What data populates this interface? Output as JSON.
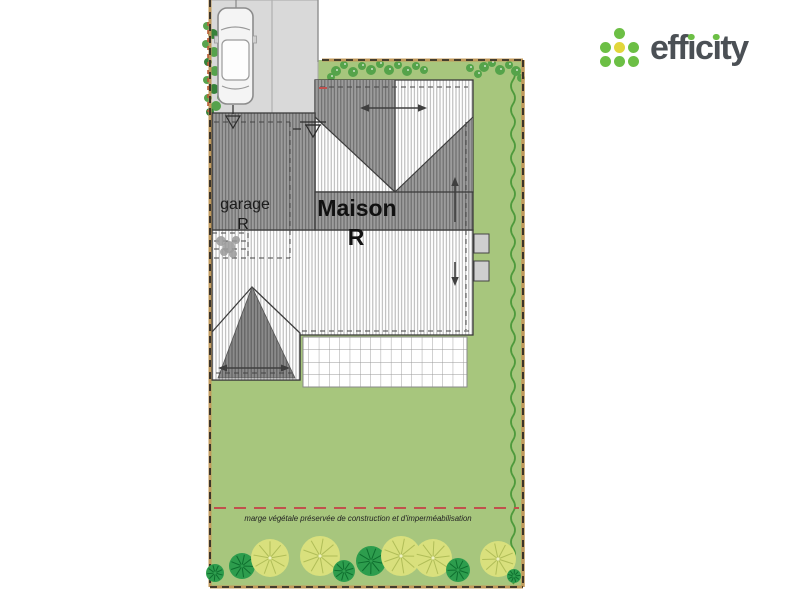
{
  "logo": {
    "name": "efficity-logo",
    "full_text": "efficity",
    "t1": "eff",
    "t2": "c",
    "t3": "ty",
    "dotless_i": "ı",
    "colors": {
      "green": "#6cbf45",
      "yellow": "#e2d63b",
      "text": "#4b5055"
    }
  },
  "plan": {
    "labels": {
      "garage_line1": "garage",
      "garage_line2": "R",
      "maison_line1": "Maison",
      "maison_line2": "R",
      "marge_note": "marge végétale préservée de construction et d'imperméabilisation"
    },
    "colors": {
      "lawn": "#a7c67d",
      "boundary_tan": "#c19a5b",
      "boundary_dash": "#1c1c1c",
      "marge_dash": "#c0504d",
      "driveway": "#d9d9d9",
      "hedge": "#4e9a3c",
      "roof_outline": "#3c3c3c",
      "window_fill": "#cfcfcf"
    },
    "decor": {
      "hedge": {
        "x": 513,
        "y1": 68,
        "y2": 584,
        "amp": 4,
        "step": 12
      },
      "tree_colors": {
        "y": {
          "fill": "#d9e07d",
          "spoke": "#b0bd58",
          "core": "#eef2c0"
        },
        "d": {
          "fill": "#2d9d4d",
          "spoke": "#0e6e2e",
          "core": "#2d9d4d"
        }
      },
      "trees": [
        {
          "x": 215,
          "y": 573,
          "r": 9,
          "c": "d"
        },
        {
          "x": 242,
          "y": 566,
          "r": 13,
          "c": "d"
        },
        {
          "x": 270,
          "y": 558,
          "r": 19,
          "c": "y"
        },
        {
          "x": 320,
          "y": 556,
          "r": 20,
          "c": "y"
        },
        {
          "x": 344,
          "y": 571,
          "r": 11,
          "c": "d"
        },
        {
          "x": 371,
          "y": 561,
          "r": 15,
          "c": "d"
        },
        {
          "x": 401,
          "y": 556,
          "r": 20,
          "c": "y"
        },
        {
          "x": 433,
          "y": 558,
          "r": 19,
          "c": "y"
        },
        {
          "x": 458,
          "y": 570,
          "r": 12,
          "c": "d"
        },
        {
          "x": 498,
          "y": 559,
          "r": 18,
          "c": "y"
        },
        {
          "x": 514,
          "y": 576,
          "r": 7,
          "c": "d"
        }
      ],
      "shrub_color": "#55a34a",
      "shrubs": [
        [
          336,
          71,
          5
        ],
        [
          344,
          65,
          4
        ],
        [
          353,
          72,
          5
        ],
        [
          362,
          66,
          4
        ],
        [
          371,
          70,
          5
        ],
        [
          380,
          64,
          4
        ],
        [
          389,
          70,
          5
        ],
        [
          398,
          65,
          4
        ],
        [
          407,
          71,
          5
        ],
        [
          416,
          66,
          4
        ],
        [
          424,
          70,
          4
        ],
        [
          331,
          77,
          4
        ],
        [
          484,
          67,
          5
        ],
        [
          492,
          63,
          4
        ],
        [
          500,
          70,
          5
        ],
        [
          509,
          65,
          4
        ],
        [
          516,
          71,
          5
        ],
        [
          521,
          78,
          4
        ],
        [
          470,
          68,
          4
        ],
        [
          478,
          74,
          4
        ]
      ],
      "vine_colors": {
        "a": "#4f9f45",
        "b": "#2e7d32"
      },
      "vines": [
        [
          207,
          26,
          4,
          "a"
        ],
        [
          213,
          34,
          5,
          "b"
        ],
        [
          206,
          44,
          4,
          "a"
        ],
        [
          214,
          52,
          5,
          "a"
        ],
        [
          208,
          62,
          4,
          "b"
        ],
        [
          215,
          71,
          5,
          "a"
        ],
        [
          207,
          80,
          4,
          "a"
        ],
        [
          214,
          89,
          5,
          "b"
        ],
        [
          208,
          98,
          4,
          "a"
        ],
        [
          216,
          106,
          5,
          "a"
        ],
        [
          222,
          42,
          4,
          "b"
        ],
        [
          221,
          97,
          4,
          "a"
        ],
        [
          225,
          62,
          3,
          "a"
        ],
        [
          210,
          112,
          4,
          "b"
        ]
      ],
      "blob_color": "#9a9a9a",
      "blobs": [
        [
          221,
          241,
          5
        ],
        [
          229,
          247,
          6
        ],
        [
          236,
          240,
          4
        ],
        [
          224,
          252,
          4
        ],
        [
          233,
          254,
          4
        ]
      ]
    }
  }
}
